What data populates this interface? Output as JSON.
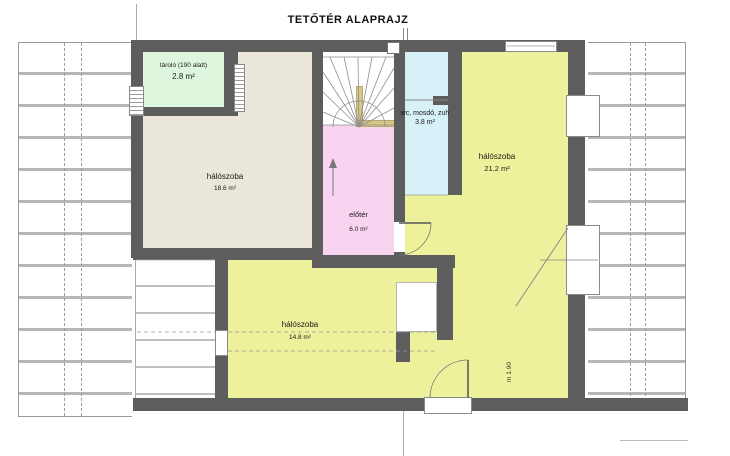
{
  "title": "TETŐTÉR ALAPRAJZ",
  "rooms": [
    {
      "id": "storage",
      "name": "tároló (190 alatt)",
      "area": "2.8 m²"
    },
    {
      "id": "bedroom-left",
      "name": "hálószoba",
      "area": "18.6 m²"
    },
    {
      "id": "hall",
      "name": "előtér",
      "area": "6.0 m²"
    },
    {
      "id": "bathroom",
      "name": "wc, mosdó, zuh",
      "area": "3.8 m²"
    },
    {
      "id": "bedroom-right",
      "name": "hálószoba",
      "area": "21.2 m²"
    },
    {
      "id": "bedroom-bottom",
      "name": "hálószoba",
      "area": "14.8 m²"
    }
  ],
  "annotations": {
    "height_marker": "m 1.90"
  },
  "colors": {
    "wall": "#5d5d5d",
    "bedroom_beige": "#eae6d9",
    "storage_green": "#ddf6dd",
    "hall_pink": "#f8d4f1",
    "bath_blue": "#d6f1f8",
    "bedroom_yellow": "#eef19c",
    "handrail_tan": "#d7c687",
    "roof_line": "#b9b7b5"
  }
}
